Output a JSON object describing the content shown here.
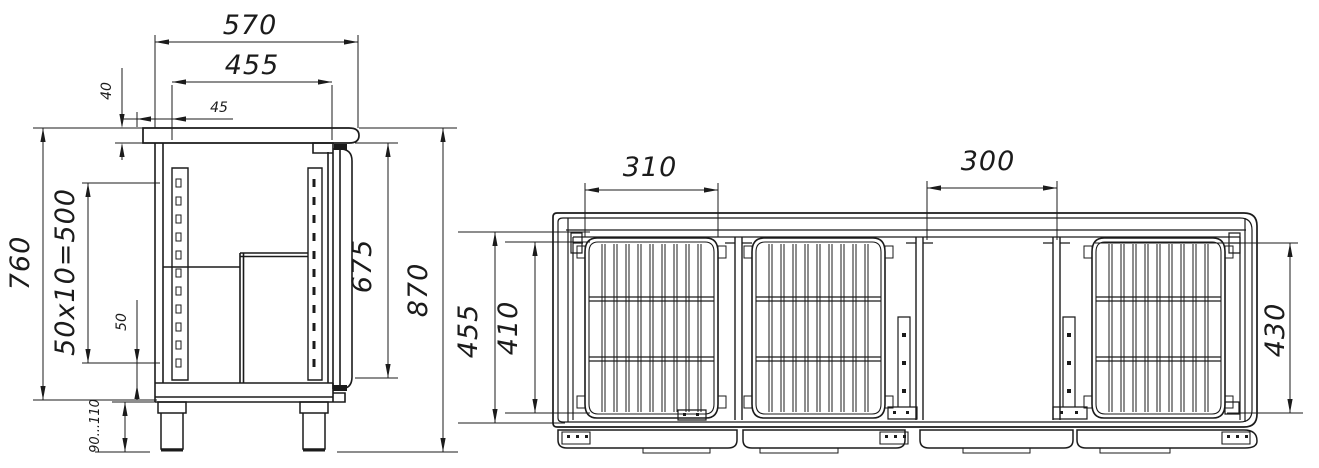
{
  "colors": {
    "line": "#1b1b1b",
    "background": "#ffffff"
  },
  "side_view": {
    "dim_top_depth": "570",
    "dim_inner_depth": "455",
    "dim_rail_inset": "45",
    "dim_top_thickness": "40",
    "dim_body_height": "760",
    "dim_slot_pitch": "50x10=500",
    "dim_bottom_offset": "50",
    "dim_leg_height": "90...110",
    "dim_door_height": "675",
    "dim_overall_height": "870"
  },
  "front_view": {
    "dim_shelf_width": "310",
    "dim_open_bay_width": "300",
    "dim_inner_height": "455",
    "dim_shelf_height": "410",
    "dim_right_bay_height": "430"
  }
}
